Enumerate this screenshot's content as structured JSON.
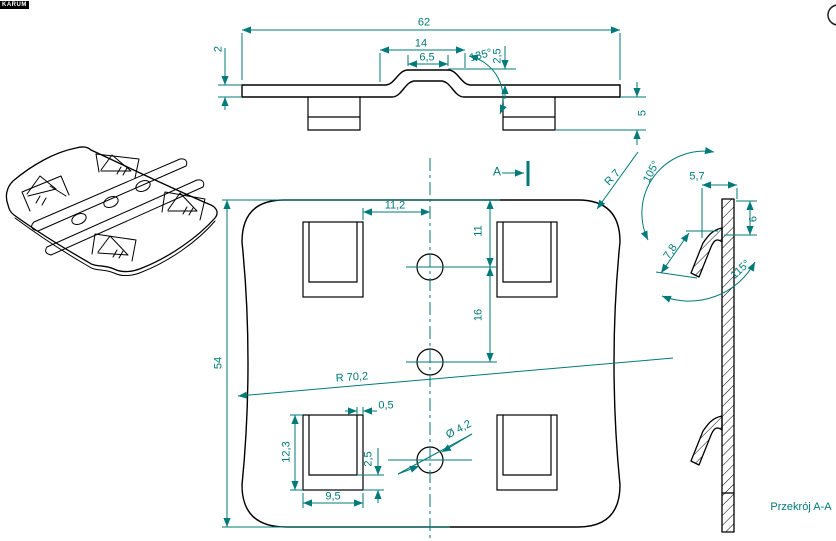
{
  "title_block": {
    "label": "KARUM"
  },
  "colors": {
    "outline": "#000000",
    "dimension": "#007a7a",
    "background": "#ffffff"
  },
  "front_view": {
    "dims": {
      "width": "62",
      "bump_width": "14",
      "bump_flat": "6,5",
      "bump_angle": "135°",
      "bump_height": "2,5",
      "thickness": "2",
      "tab_drop": "5"
    }
  },
  "plan_view": {
    "section_marker": "A",
    "dims": {
      "slot_to_center": "11,2",
      "hole_top_offset": "11",
      "hole_pitch": "16",
      "height": "54",
      "side_radius": "R 70,2",
      "slot_width": "0,5",
      "cutout_height": "12,3",
      "cutout_width": "9,5",
      "cutout_bottom_gap": "2,5",
      "hole_diameter": "Ø 4,2",
      "corner_radius": "R 7"
    }
  },
  "section_view": {
    "label": "Przekrój A-A",
    "dims": {
      "top_angle": "105°",
      "tab_offset": "5,7",
      "tab_top_distance": "6",
      "tab_length": "7,8",
      "bottom_angle": "115°"
    }
  }
}
